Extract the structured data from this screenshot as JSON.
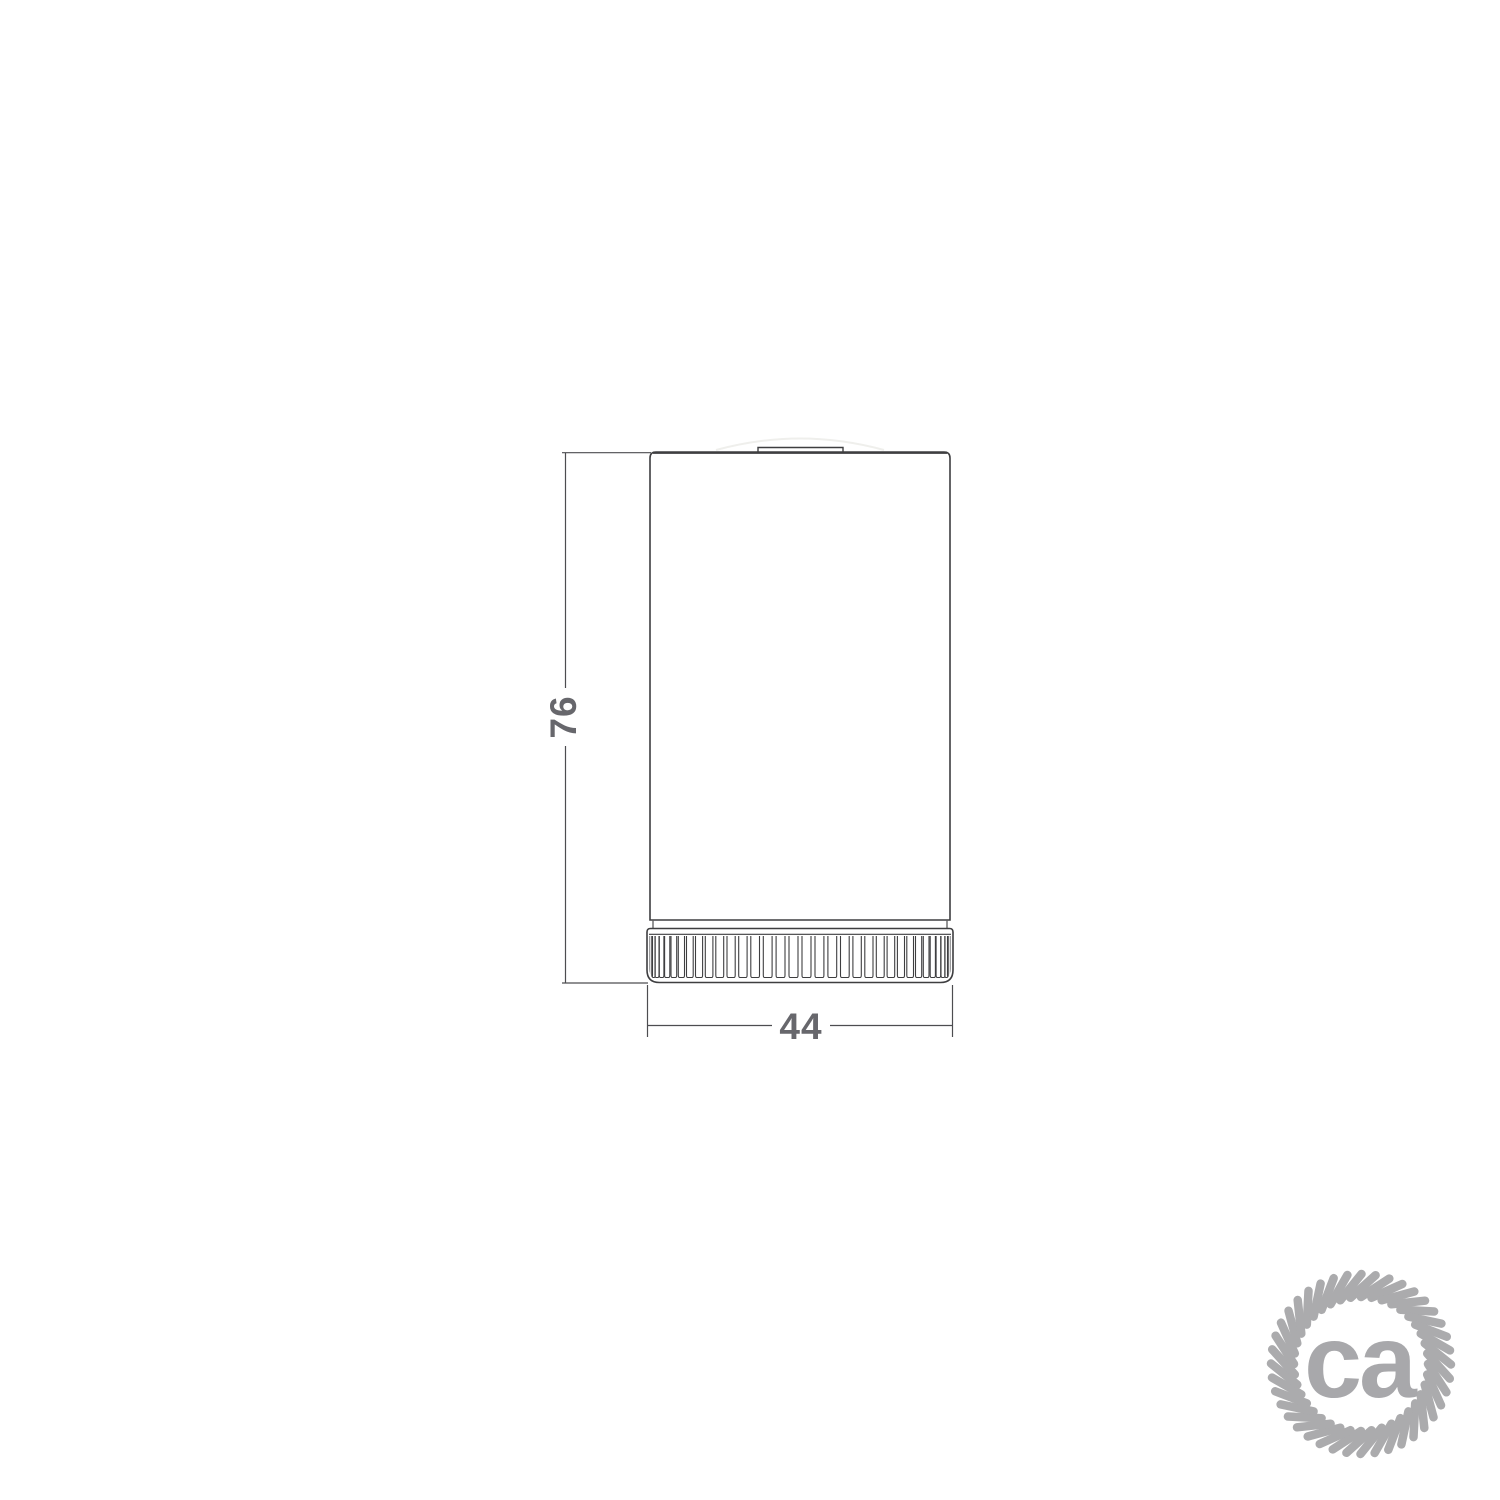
{
  "page": {
    "background": "#ffffff",
    "width": 1500,
    "height": 1500
  },
  "drawing": {
    "kind": "technical-line-drawing",
    "stroke_color": "#3e3e40",
    "dim_line_color": "#4d4d50",
    "dim_text_color": "#67676c",
    "dimensions": {
      "height_label": "76",
      "width_label": "44"
    },
    "geometry": {
      "body": {
        "x": 650,
        "y": 452,
        "w": 300,
        "h": 468,
        "top_corner_r": 6
      },
      "tab": {
        "x": 758,
        "y": 447.5,
        "w": 85
      },
      "collar": {
        "x1": 653,
        "x2": 947,
        "y1": 920,
        "y2": 928.5
      },
      "ring": {
        "x": 647,
        "y": 928.5,
        "w": 306,
        "h": 54,
        "rib_top": 936,
        "rib_bottom": 977.5,
        "rib_count": 34
      },
      "vdim": {
        "x": 565.5,
        "y1": 453,
        "y2": 983,
        "label_cx": 563,
        "label_cy": 717
      },
      "hdim": {
        "y": 1025.5,
        "x1": 647,
        "x2": 953,
        "label_cx": 801,
        "label_cy": 1026
      }
    }
  },
  "logo": {
    "text": "ca",
    "rope_color": "#ababad",
    "text_color": "#a8a8ab",
    "cx": 1361,
    "cy": 1364,
    "outer_r": 90,
    "inner_r": 67,
    "strands": 40,
    "strand_width": 8.5,
    "twist": 0.32
  }
}
